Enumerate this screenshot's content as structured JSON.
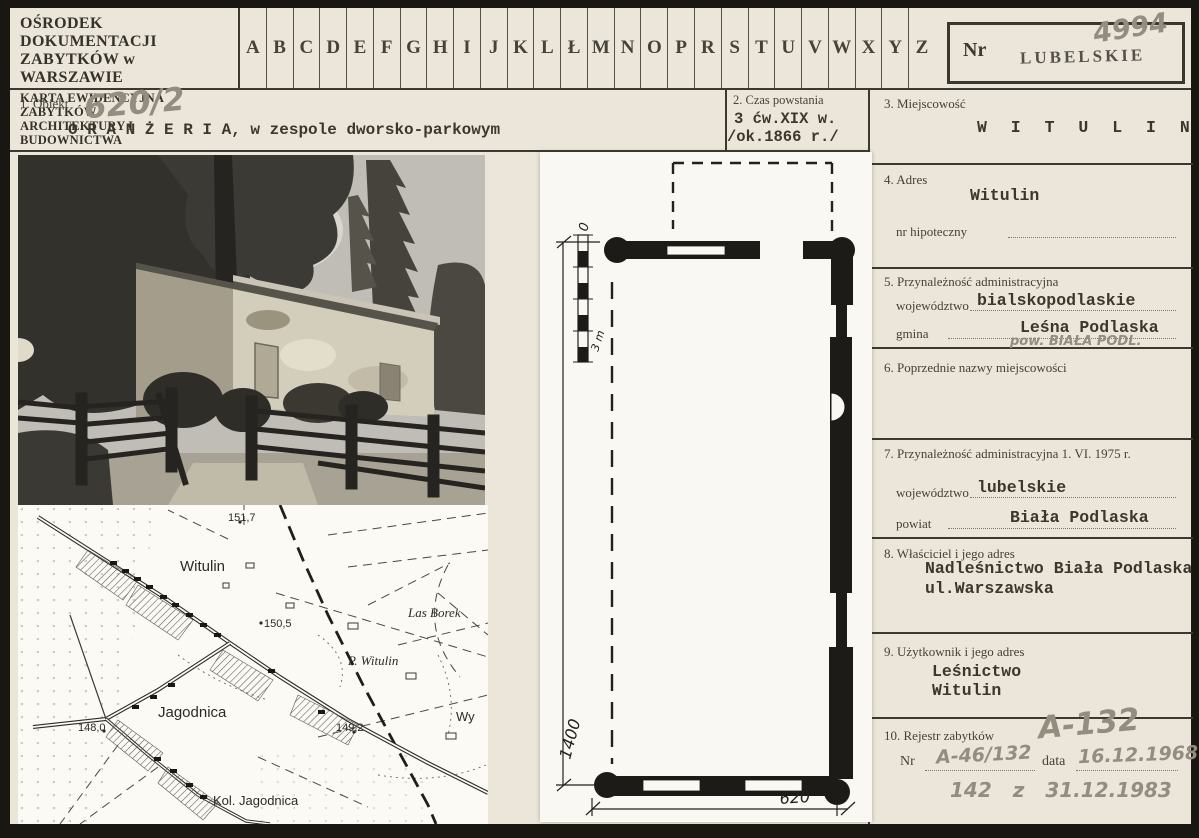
{
  "header": {
    "org_line1": "OŚRODEK DOKUMENTACJI",
    "org_line2": "ZABYTKÓW w WARSZAWIE",
    "card_type_line1": "KARTA EWIDENCYJNA ZABYTKÓW",
    "card_type_line2": "ARCHITEKTURY I BUDOWNICTWA",
    "alphabet": [
      "A",
      "B",
      "C",
      "D",
      "E",
      "F",
      "G",
      "H",
      "I",
      "J",
      "K",
      "L",
      "Ł",
      "M",
      "N",
      "O",
      "P",
      "R",
      "S",
      "T",
      "U",
      "V",
      "W",
      "X",
      "Y",
      "Z"
    ],
    "nr_label": "Nr",
    "region_stamp": "LUBELSKIE",
    "card_number_pencil": "4994"
  },
  "object_row": {
    "field1_label": "1. Obiekt",
    "object_number_pencil": "620/2",
    "object_name": "O R A N Ż E R I A,  w zespole dworsko-parkowym",
    "field2_label": "2. Czas powstania",
    "date_line1": "3 ćw.XIX w.",
    "date_line2": "/ok.1866 r./"
  },
  "fields": {
    "f3": {
      "label": "3. Miejscowość",
      "value": "W I T U L I N"
    },
    "f4": {
      "label": "4. Adres",
      "value": "Witulin",
      "hipoteczny_label": "nr hipoteczny"
    },
    "f5": {
      "label": "5. Przynależność administracyjna",
      "woj_label": "województwo",
      "woj_value": "bialskopodlaskie",
      "gmina_label": "gmina",
      "gmina_value": "Leśna Podlaska",
      "pencil_note": "pow. BIAŁA PODL."
    },
    "f6": {
      "label": "6. Poprzednie nazwy miejscowości"
    },
    "f7": {
      "label": "7. Przynależność administracyjna 1. VI. 1975 r.",
      "woj_label": "województwo",
      "woj_value": "lubelskie",
      "powiat_label": "powiat",
      "powiat_value": "Biała Podlaska"
    },
    "f8": {
      "label": "8. Właściciel i jego adres",
      "line1": "Nadleśnictwo Biała Podlaska",
      "line2": "ul.Warszawska"
    },
    "f9": {
      "label": "9. Użytkownik i jego adres",
      "line1": "Leśnictwo",
      "line2": "Witulin"
    },
    "f10": {
      "label": "10. Rejestr zabytków",
      "pencil_reg": "A-132",
      "nr_label": "Nr",
      "nr_value": "A-46/132",
      "date_label": "data",
      "date_value": "16.12.1968",
      "pencil_note": "142    z    31.12.1983"
    }
  },
  "plan": {
    "dim_height": "1400",
    "dim_width": "620",
    "scale_top": "0",
    "scale_bottom": "3 m"
  },
  "map": {
    "labels": {
      "witulin": "Witulin",
      "jagodnica": "Jagodnica",
      "kol_jagodnica": "Kol. Jagodnica",
      "las_borek": "Las Borek",
      "p_witulin": "P. Witulin",
      "wy": "Wy",
      "h1517": "151,7",
      "h1505": "150,5",
      "h1480": "148,0",
      "h1492": "149,2"
    }
  }
}
